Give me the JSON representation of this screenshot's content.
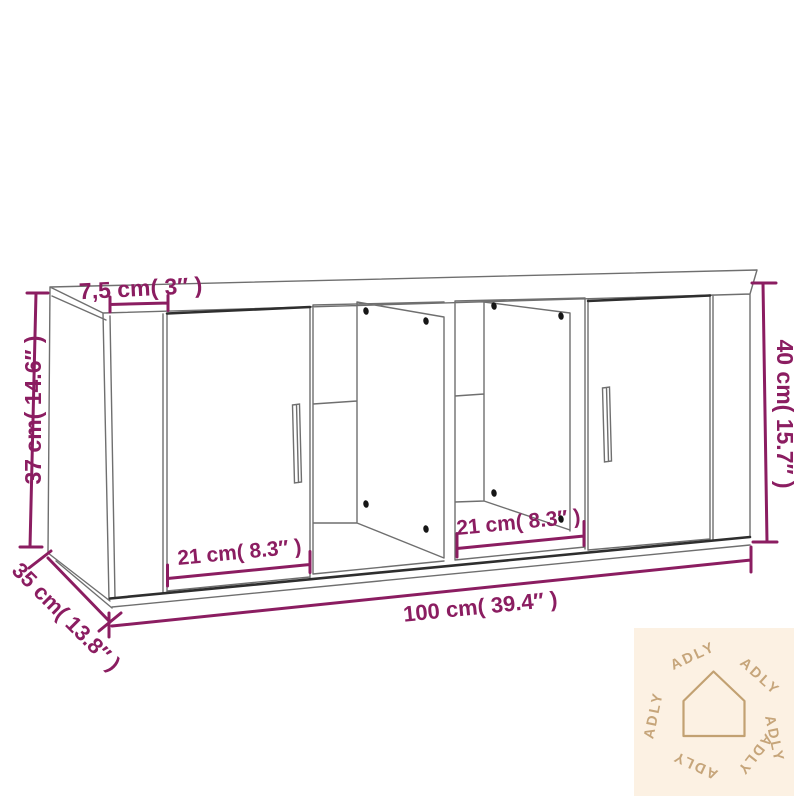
{
  "diagram": {
    "title": "cabinet-dimension-diagram",
    "labels": {
      "top_thickness": "7,5 cm( 3″ )",
      "left_height": "37 cm( 14.6″ )",
      "right_height": "40 cm( 15.7″ )",
      "depth": "35 cm( 13.8″ )",
      "width": "100 cm( 39.4″ )",
      "left_door_width": "21 cm( 8.3″ )",
      "middle_section_width": "21 cm( 8.3″ )"
    },
    "colors": {
      "dimension_accent": "#8b1d61",
      "outline": "#6f6f6f",
      "outline_dark": "#2e2e2e",
      "watermark_bg": "#fcf1e3",
      "watermark_fg": "#c6a57a"
    },
    "icons": {
      "watermark_icon": "house-icon"
    }
  },
  "watermark": {
    "brand": "ADLY"
  }
}
